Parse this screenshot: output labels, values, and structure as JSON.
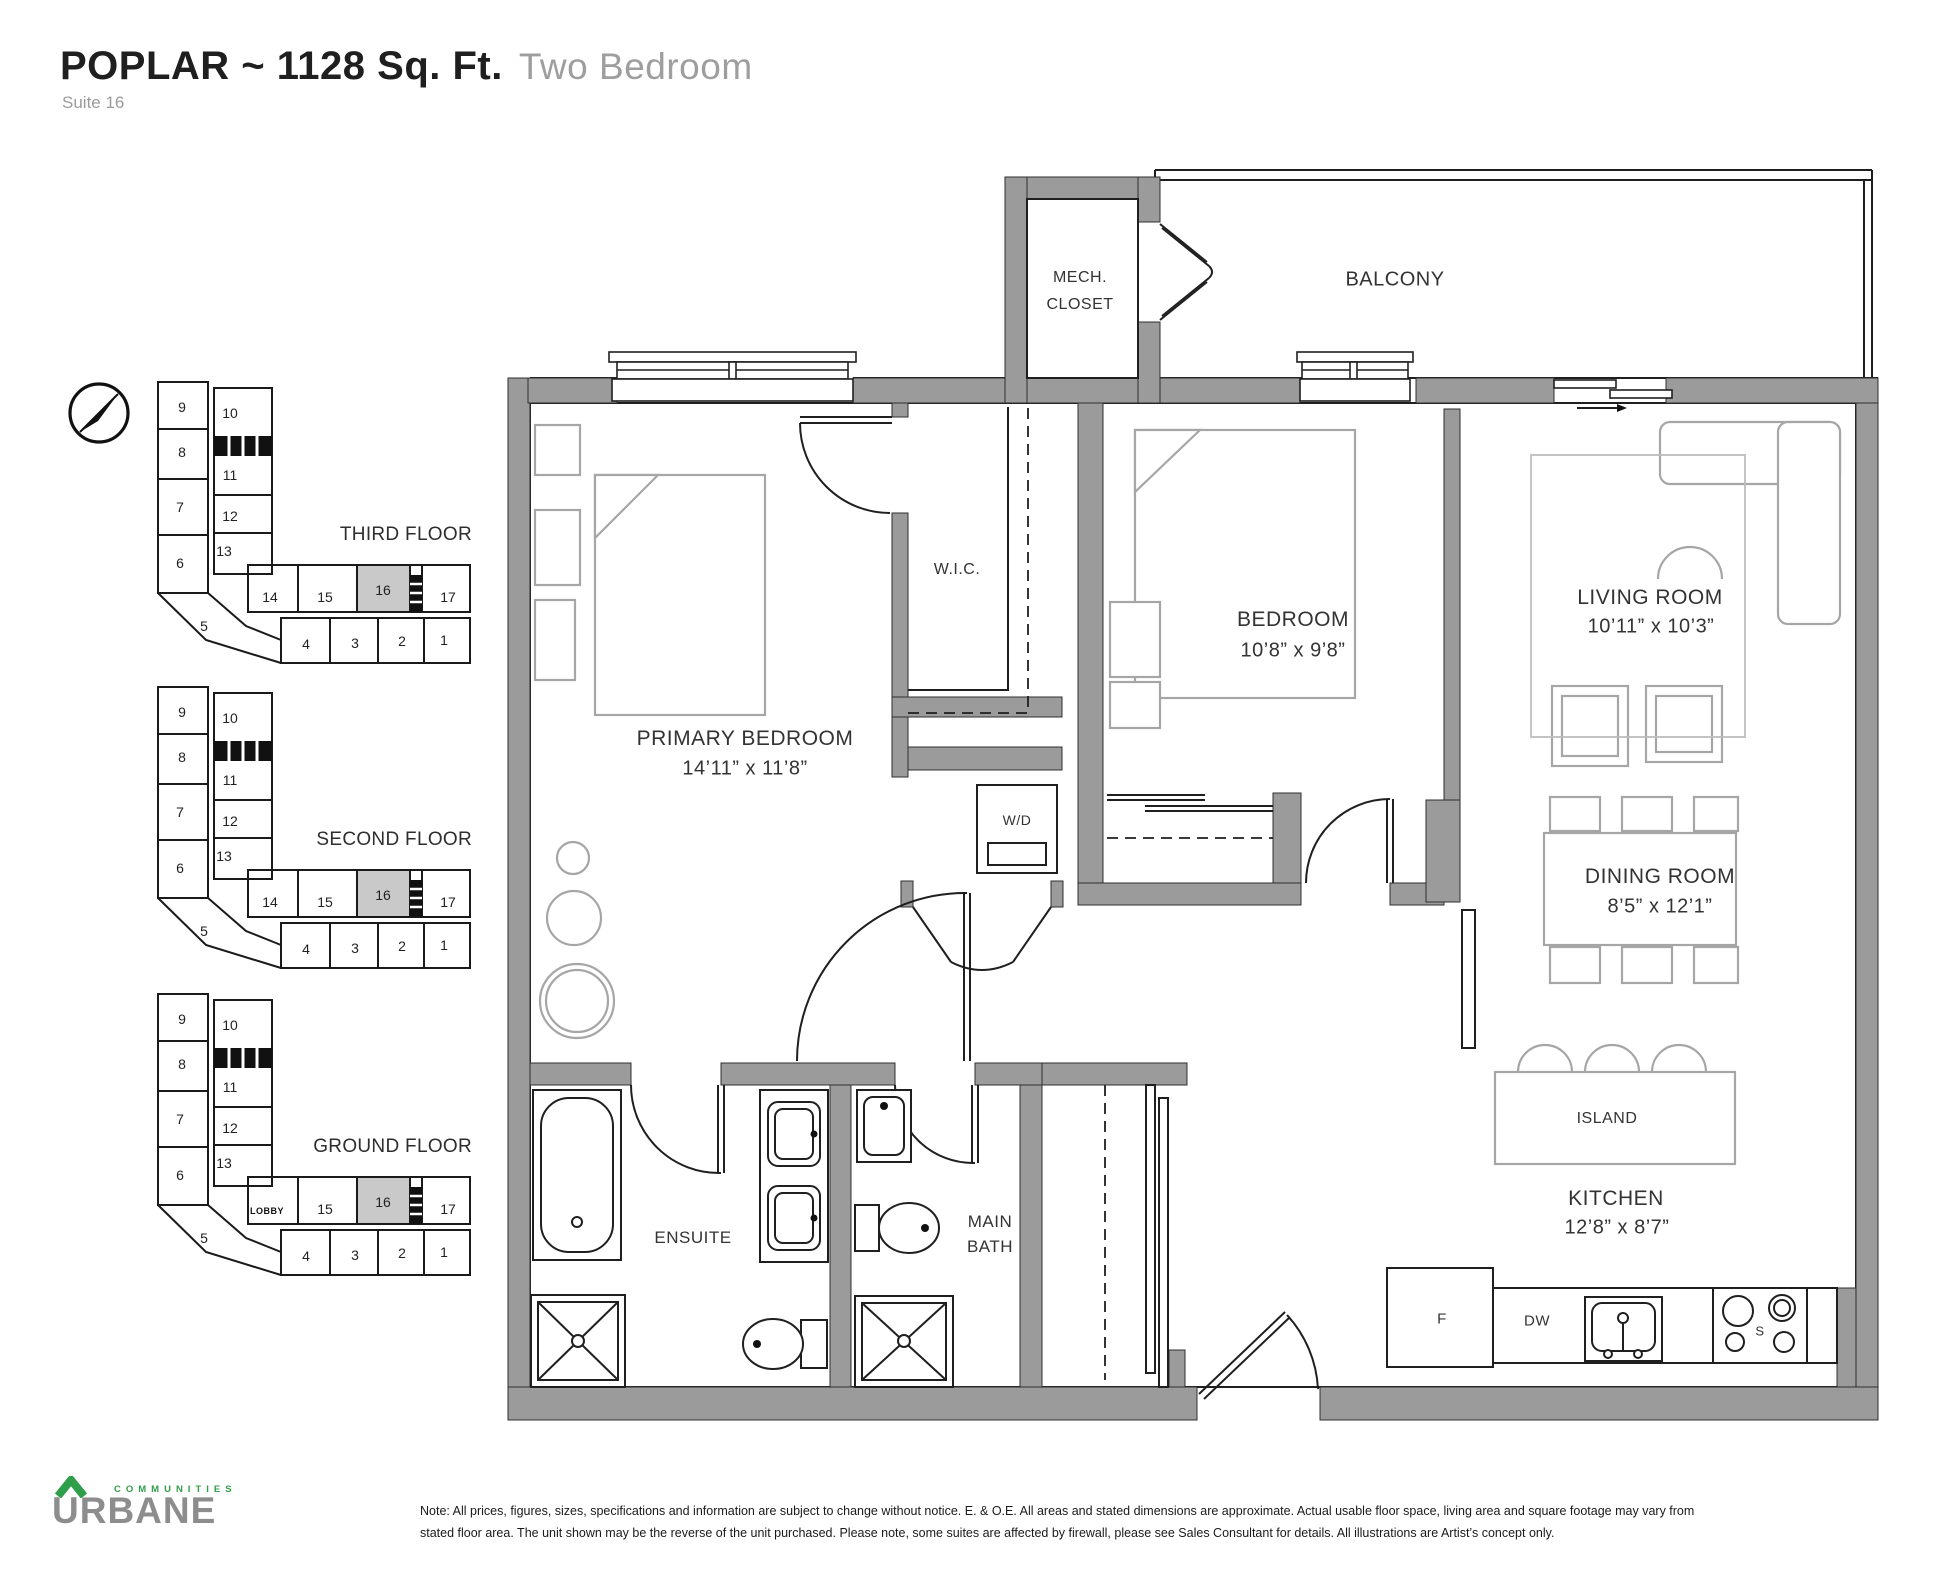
{
  "header": {
    "title": "POPLAR ~ 1128 Sq. Ft.",
    "subtitle": "Two Bedroom",
    "suite": "Suite 16"
  },
  "keyplans": [
    {
      "label": "THIRD FLOOR",
      "highlight": "16",
      "lobby": null,
      "units": [
        "9",
        "10",
        "8",
        "11",
        "7",
        "12",
        "6",
        "13",
        "5",
        "14",
        "15",
        "16",
        "17",
        "4",
        "3",
        "2",
        "1"
      ]
    },
    {
      "label": "SECOND FLOOR",
      "highlight": "16",
      "lobby": null,
      "units": [
        "9",
        "10",
        "8",
        "11",
        "7",
        "12",
        "6",
        "13",
        "5",
        "14",
        "15",
        "16",
        "17",
        "4",
        "3",
        "2",
        "1"
      ]
    },
    {
      "label": "GROUND FLOOR",
      "highlight": "16",
      "lobby": "LOBBY",
      "units": [
        "9",
        "10",
        "8",
        "11",
        "7",
        "12",
        "6",
        "13",
        "5",
        "15",
        "16",
        "17",
        "4",
        "3",
        "2",
        "1"
      ]
    }
  ],
  "plan": {
    "balcony": "BALCONY",
    "mech_closet": {
      "line1": "MECH.",
      "line2": "CLOSET"
    },
    "wic": "W.I.C.",
    "primary_bedroom": {
      "name": "PRIMARY BEDROOM",
      "dims": "14’11” x 11’8”"
    },
    "bedroom": {
      "name": "BEDROOM",
      "dims": "10’8” x 9’8”"
    },
    "living_room": {
      "name": "LIVING ROOM",
      "dims": "10’11” x 10’3”"
    },
    "dining_room": {
      "name": "DINING ROOM",
      "dims": "8’5” x 12’1”"
    },
    "kitchen": {
      "name": "KITCHEN",
      "dims": "12’8” x 8’7”"
    },
    "ensuite": "ENSUITE",
    "main_bath": {
      "line1": "MAIN",
      "line2": "BATH"
    },
    "island": "ISLAND",
    "laundry": "W/D",
    "appliances": {
      "fridge": "F",
      "dishwasher": "DW",
      "stove": "S"
    }
  },
  "footer": {
    "logo_word": "URBANE",
    "logo_tagline": "COMMUNITIES",
    "disclaimer": [
      "Note: All prices, figures, sizes, specifications and information are subject to change without notice. E. & O.E. All areas and stated dimensions are approximate. Actual usable floor space, living area and square footage may vary from",
      "stated floor area. The unit shown may be the reverse of the unit purchased. Please note, some suites are affected by firewall, please see Sales Consultant for details. All illustrations are Artist’s concept only."
    ]
  },
  "colors": {
    "wall_gray": "#9b9b9b",
    "furniture_gray": "#a6a6a6",
    "suite_highlight": "#c9c9c9",
    "logo_green": "#2f9e4a",
    "logo_gray": "#8d8d8d"
  }
}
